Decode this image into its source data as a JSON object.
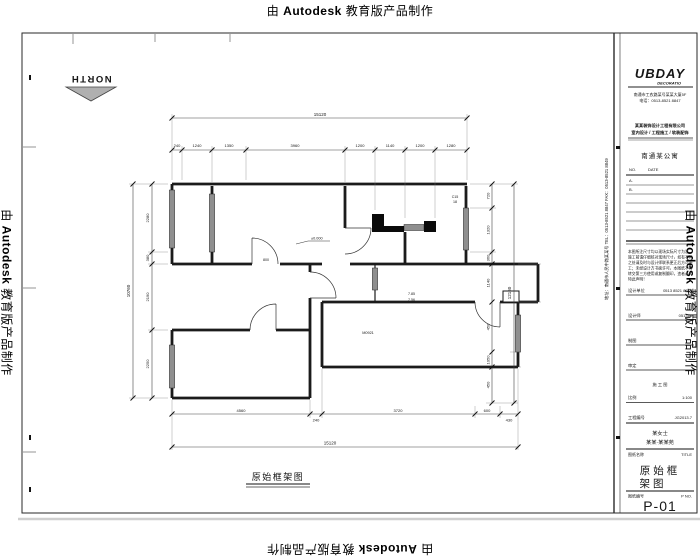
{
  "watermark": {
    "prefix": "由",
    "brand": "Autodesk",
    "suffix": "教育版产品制作"
  },
  "north": {
    "label": "NORTH"
  },
  "drawing_label": "原始框架图",
  "plan": {
    "tags": {
      "level": "±0.000",
      "win_tag1": "C15",
      "win_tag2": "18",
      "pair1": "7.85",
      "pair2": "7.56",
      "door": "800",
      "mtag": "M0921"
    },
    "dims": {
      "top_overall": "15120",
      "top_segments": [
        "240",
        "1240",
        "1350",
        "3960",
        "1200",
        "1140",
        "1200",
        "1280"
      ],
      "left_overall": "10760",
      "left_segments": [
        "2280",
        "380",
        "2190",
        "2250"
      ],
      "right_overall": "12160",
      "right_segments": [
        "720",
        "1320",
        "360",
        "1140",
        "450",
        "1050",
        "450"
      ],
      "bottom_overall": "15120",
      "bottom_segments": [
        "4560",
        "240",
        "3720",
        "600",
        "430"
      ]
    }
  },
  "titleblock": {
    "logo": "UBDAY",
    "logo_sub": "DECORATIO",
    "addr1": "南通市工农路某号某某大厦5F",
    "addr2": "电话：0513-8521 8847",
    "slogan1": "某某装饰设计工程有限公司",
    "slogan2": "室内设计 / 工程施工 / 软装配饰",
    "project": "南通某公寓",
    "rev": {
      "no": "NO.",
      "date": "DATE",
      "rows": [
        "A.",
        "B."
      ]
    },
    "notes": [
      "本图所注尺寸均以现场实际尺寸为准，",
      "施工前请仔细核对现场尺寸，如有不符",
      "之处请及时与设计师联系更正后方可施",
      "工；未经设计方书面许可，本图纸不得",
      "转交第三方使用或复制翻印，违者必究",
      "特此声明！"
    ],
    "fields": [
      {
        "label": "设计单位",
        "value": "0513 8521 8847"
      },
      {
        "label": "设计师",
        "value": "051316"
      },
      {
        "label": "制图",
        "value": ""
      },
      {
        "label": "审定",
        "value": ""
      },
      {
        "label": "比例",
        "value": "1:100"
      },
      {
        "label": "工程编号",
        "value": "JG2013.7"
      }
    ],
    "stage": "施 工 图",
    "client1": "某女士",
    "client2": "某某·某某苑",
    "title_row": {
      "label": "图纸名称",
      "en": "TITLE"
    },
    "sheet_title_line1": "原始框",
    "sheet_title_line2": "架图",
    "no_row": {
      "label": "图纸编号",
      "en": "P NO."
    },
    "sheet_no": "P-01",
    "contact": "地址：南通市人民中路某某号  TEL：0513-8521 8847  FAX：0513-8521 8849"
  }
}
